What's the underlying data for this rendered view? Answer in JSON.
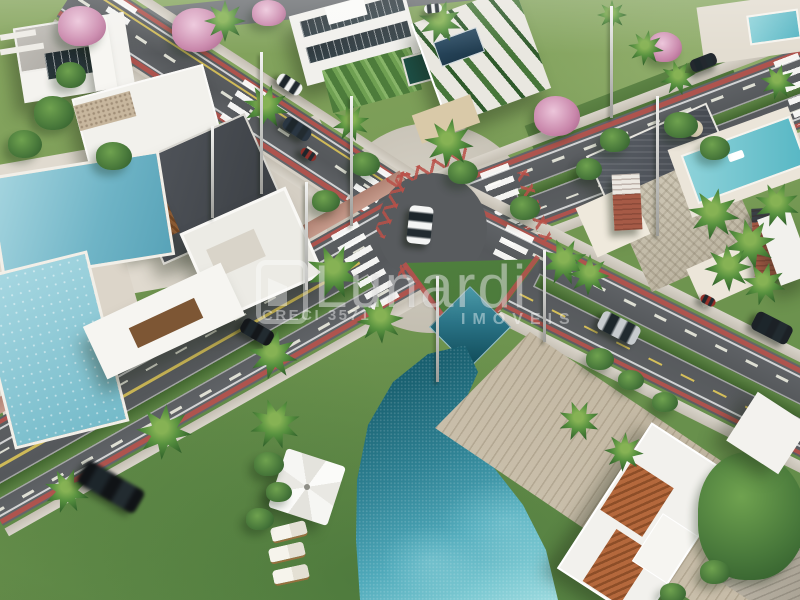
{
  "scene": {
    "type": "aerial-3d-render",
    "description": "Aerial rendering of a planned residential community: X-shaped street intersection with crosswalks and red bike lanes, modern white houses, swimming pools, palm trees and cars",
    "palette": {
      "asphalt": "#5b5e61",
      "concrete": "#cdc7bb",
      "paver": "#d6d0c5",
      "grass": "#6f9b55",
      "grass_dark": "#4c7a3c",
      "red_lane": "#b5524c",
      "lane_white": "#efeee8",
      "lane_yellow": "#d9c355",
      "roof_white": "#f3f2ee",
      "deck_dark": "#45494e",
      "wood": "#8a5a33",
      "wood_roof": "#cfc5b2",
      "slate_roof": "#4a4f56",
      "brick": "#a05844",
      "terracotta": "#b06a3e",
      "pool_light": "#8ecbd8",
      "pool_deep": "#1b6373",
      "pool_teal": "#4fb0bf",
      "hedge": "#3f7434",
      "palm": "#3c7838",
      "pink_tree": "#d9a8c4",
      "sand": "#d9c9a8"
    }
  },
  "watermark": {
    "brand": "Lunardi",
    "registration": "CRECI 3571",
    "tagline": "IMÓVEIS"
  }
}
